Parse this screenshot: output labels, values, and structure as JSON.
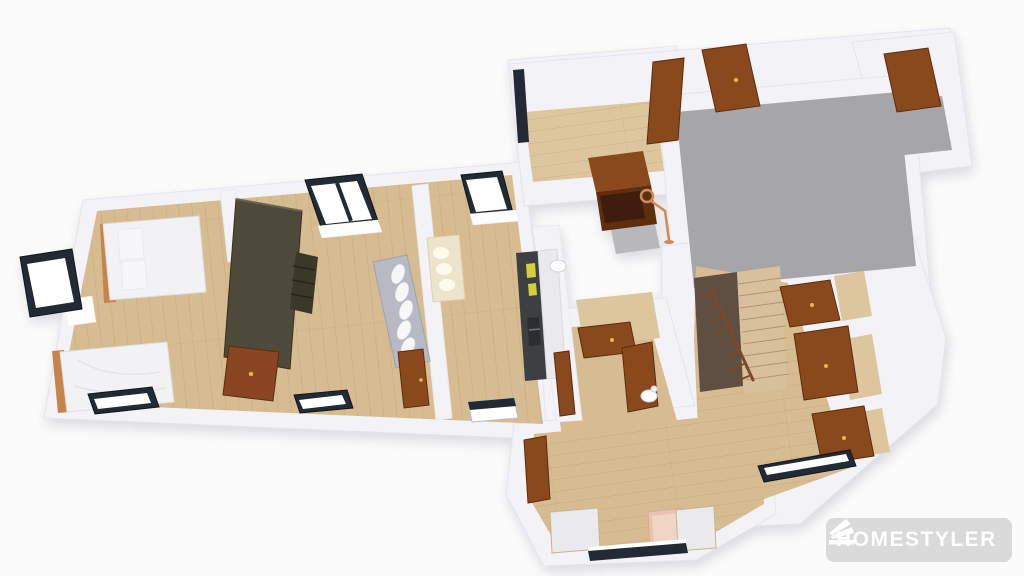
{
  "watermark": {
    "label": "HOMESTYLER",
    "icon": "homestyler-fan-logo-icon"
  },
  "colors": {
    "background": "#fbfbfb",
    "wall": "#f3f3f7",
    "floor_wood": "#d7bc92",
    "floor_wood_light": "#ddc59e",
    "floor_concrete": "#a6a6a9",
    "window_frame": "#222a35",
    "window_glass": "#ffffff",
    "door_wood": "#8a4a1e",
    "bed_white": "#f2f2f4",
    "pine": "#c58449",
    "wardrobe_dark": "#4e4a3a",
    "dresser_red": "#8a4520",
    "sofa": "#b7bac4",
    "sideboard_cream": "#eee4cc",
    "counter_dark": "#3c4043",
    "cabinet_white": "#e9e9ee",
    "accent_yellow": "#d5ce3e",
    "armchair_pink": "#e7c4b2",
    "stair_wood": "#d9c09c",
    "railing_brown": "#7a4a28",
    "lamp_copper": "#cf8a57",
    "watermark_bg": "#d9d9d9",
    "watermark_text": "#ffffff"
  },
  "scene": {
    "view": "3d-floor-plan-render",
    "rooms": [
      "bedroom",
      "living-room",
      "kitchen",
      "hallway",
      "entry",
      "patio"
    ],
    "furniture": [
      "double-bed",
      "single-bed",
      "wardrobe",
      "shelf-unit",
      "dresser",
      "sofa",
      "sideboard",
      "kitchen-counter",
      "kitchen-sink",
      "oven",
      "floor-lamp",
      "staircase",
      "stair-railing",
      "armchair",
      "storage-cabinet",
      "toilet"
    ],
    "architecture": {
      "doors": 11,
      "windows": 9,
      "floors": [
        "wood",
        "concrete"
      ]
    }
  }
}
